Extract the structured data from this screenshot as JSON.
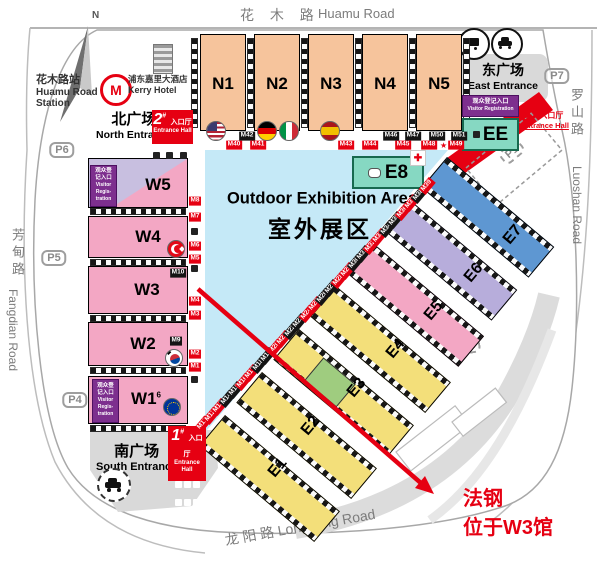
{
  "colors": {
    "accent_red": "#E60012",
    "hall_orange": "#F6C49C",
    "hall_pink": "#F3A7C4",
    "hall_yellow": "#F3DF7A",
    "hall_green": "#9FCC7F",
    "hall_lavender": "#B7ADDB",
    "hall_blue": "#5E97D2",
    "teal": "#86D8C2",
    "outdoor_blue": "#C5E9F7",
    "purple": "#7D2F8E"
  },
  "roads": {
    "north_zh": "花  木  路",
    "north_en": "Huamu Road",
    "east_zh": "罗山路",
    "east_en": "Luoshan Road",
    "west_zh": "芳甸路",
    "west_en": "Fangdian Road",
    "south_text": "龙  阳  路  Longyang Road"
  },
  "compass_label": "N",
  "station": {
    "zh": "花木路站",
    "en1": "Huamu Road",
    "en2": "Station",
    "logo_letter": "M"
  },
  "hotel": {
    "zh": "浦东嘉里大酒店",
    "en": "Kerry Hotel"
  },
  "plazas": {
    "north_zh": "北广场",
    "north_en": "North Entrance",
    "south_zh": "南广场",
    "south_en": "South Entrance",
    "east_zh": "东广场",
    "east_en": "East Entrance"
  },
  "entrance_halls": {
    "no1": {
      "num": "1",
      "hash": "#",
      "zh": "入口厅",
      "en": "Entrance Hall"
    },
    "no2": {
      "num": "2",
      "hash": "#",
      "zh": "入口厅",
      "en": "Entrance Hall"
    },
    "no3": {
      "num": "3",
      "hash": "#",
      "zh": "入口厅",
      "en": "Entrance Hall"
    }
  },
  "visitor_reg": {
    "zh": "观众登记入口",
    "en": "Visitor Registration",
    "l1": "观众登",
    "l2": "记入口",
    "l3": "Visitor",
    "l4": "Regis-",
    "l5": "tration"
  },
  "outdoor": {
    "en": "Outdoor Exhibition Area",
    "zh": "室外展区"
  },
  "halls": {
    "n1": "N1",
    "n2": "N2",
    "n3": "N3",
    "n4": "N4",
    "n5": "N5",
    "w1": "W1",
    "w1_sup": "6",
    "w2": "W2",
    "w3": "W3",
    "w4": "W4",
    "w5": "W5",
    "e8": "E8",
    "ee": "EE"
  },
  "e_labels": [
    {
      "label": "E1",
      "x": 278,
      "y": 468,
      "rot": -50
    },
    {
      "label": "E2",
      "x": 311,
      "y": 426,
      "rot": -50
    },
    {
      "label": "E3",
      "x": 357,
      "y": 388,
      "rot": -50
    },
    {
      "label": "E4",
      "x": 396,
      "y": 349,
      "rot": -50
    },
    {
      "label": "E5",
      "x": 434,
      "y": 311,
      "rot": -50
    },
    {
      "label": "E6",
      "x": 474,
      "y": 273,
      "rot": -50
    },
    {
      "label": "E7",
      "x": 513,
      "y": 235,
      "rot": -50
    }
  ],
  "parking": [
    {
      "label": "P1",
      "x": 512,
      "y": 152,
      "rot": -40,
      "cls": "p-dash"
    },
    {
      "label": "P2",
      "x": 468,
      "y": 346,
      "rot": -10,
      "cls": "p-dash"
    },
    {
      "label": "P3",
      "x": 382,
      "y": 432,
      "rot": -15,
      "cls": "p-dash"
    },
    {
      "label": "P4",
      "x": 75,
      "y": 400,
      "rot": 0
    },
    {
      "label": "P5",
      "x": 54,
      "y": 258,
      "rot": 0
    },
    {
      "label": "P6",
      "x": 62,
      "y": 150,
      "rot": 0
    },
    {
      "label": "P7",
      "x": 557,
      "y": 76,
      "rot": 0
    }
  ],
  "gates": {
    "north_black": [
      {
        "label": "M42",
        "x": 247,
        "y": 136,
        "cls": "g-black"
      },
      {
        "label": "M46",
        "x": 391,
        "y": 136,
        "cls": "g-black"
      },
      {
        "label": "M47",
        "x": 413,
        "y": 136,
        "cls": "g-black"
      },
      {
        "label": "M50",
        "x": 437,
        "y": 136,
        "cls": "g-black"
      },
      {
        "label": "M51",
        "x": 459,
        "y": 136,
        "cls": "g-black"
      }
    ],
    "north_red": [
      {
        "label": "M40",
        "x": 234,
        "y": 145,
        "cls": "g-red"
      },
      {
        "label": "M41",
        "x": 258,
        "y": 145,
        "cls": "g-red"
      },
      {
        "label": "M43",
        "x": 346,
        "y": 145,
        "cls": "g-red"
      },
      {
        "label": "M44",
        "x": 370,
        "y": 145,
        "cls": "g-red"
      },
      {
        "label": "M45",
        "x": 403,
        "y": 145,
        "cls": "g-red"
      },
      {
        "label": "M48",
        "x": 429,
        "y": 145,
        "cls": "g-red"
      },
      {
        "label": "M49",
        "x": 456,
        "y": 145,
        "cls": "g-red"
      }
    ],
    "west": [
      {
        "label": "M8",
        "x": 195,
        "y": 201,
        "cls": "g-red"
      },
      {
        "label": "M7",
        "x": 195,
        "y": 217,
        "cls": "g-red"
      },
      {
        "label": "M6",
        "x": 195,
        "y": 246,
        "cls": "g-red"
      },
      {
        "label": "M5",
        "x": 195,
        "y": 259,
        "cls": "g-red"
      },
      {
        "label": "M10",
        "x": 178,
        "y": 273,
        "cls": "g-black"
      },
      {
        "label": "M4",
        "x": 195,
        "y": 301,
        "cls": "g-red"
      },
      {
        "label": "M3",
        "x": 195,
        "y": 315,
        "cls": "g-red"
      },
      {
        "label": "M9",
        "x": 176,
        "y": 341,
        "cls": "g-black"
      },
      {
        "label": "M2",
        "x": 195,
        "y": 354,
        "cls": "g-red"
      },
      {
        "label": "M1",
        "x": 195,
        "y": 367,
        "cls": "g-red"
      }
    ],
    "diag": [
      {
        "label": "M11",
        "x": 203,
        "y": 424,
        "rot": -50,
        "cls": "g-red"
      },
      {
        "label": "M12",
        "x": 211,
        "y": 416,
        "rot": -50,
        "cls": "g-red"
      },
      {
        "label": "M13",
        "x": 219,
        "y": 407,
        "rot": -50,
        "cls": "g-red"
      },
      {
        "label": "M14",
        "x": 227,
        "y": 399,
        "rot": -50,
        "cls": "g-black"
      },
      {
        "label": "M15",
        "x": 235,
        "y": 390,
        "rot": -50,
        "cls": "g-black"
      },
      {
        "label": "M16",
        "x": 243,
        "y": 382,
        "rot": -50,
        "cls": "g-red"
      },
      {
        "label": "M17",
        "x": 251,
        "y": 373,
        "rot": -50,
        "cls": "g-red"
      },
      {
        "label": "M18",
        "x": 259,
        "y": 365,
        "rot": -50,
        "cls": "g-black"
      },
      {
        "label": "M19",
        "x": 267,
        "y": 356,
        "rot": -50,
        "cls": "g-black"
      },
      {
        "label": "M20",
        "x": 275,
        "y": 348,
        "rot": -50,
        "cls": "g-red"
      },
      {
        "label": "M21",
        "x": 283,
        "y": 339,
        "rot": -50,
        "cls": "g-red"
      },
      {
        "label": "M22",
        "x": 291,
        "y": 331,
        "rot": -50,
        "cls": "g-black"
      },
      {
        "label": "M23",
        "x": 299,
        "y": 322,
        "rot": -50,
        "cls": "g-black"
      },
      {
        "label": "M24",
        "x": 307,
        "y": 314,
        "rot": -50,
        "cls": "g-red"
      },
      {
        "label": "M25",
        "x": 315,
        "y": 305,
        "rot": -50,
        "cls": "g-red"
      },
      {
        "label": "M26",
        "x": 323,
        "y": 297,
        "rot": -50,
        "cls": "g-black"
      },
      {
        "label": "M27",
        "x": 331,
        "y": 288,
        "rot": -50,
        "cls": "g-black"
      },
      {
        "label": "M28",
        "x": 339,
        "y": 280,
        "rot": -50,
        "cls": "g-red"
      },
      {
        "label": "M29",
        "x": 347,
        "y": 271,
        "rot": -50,
        "cls": "g-red"
      },
      {
        "label": "M30",
        "x": 355,
        "y": 263,
        "rot": -50,
        "cls": "g-black"
      },
      {
        "label": "M31",
        "x": 363,
        "y": 254,
        "rot": -50,
        "cls": "g-black"
      },
      {
        "label": "M32",
        "x": 371,
        "y": 246,
        "rot": -50,
        "cls": "g-red"
      },
      {
        "label": "M33",
        "x": 379,
        "y": 237,
        "rot": -50,
        "cls": "g-red"
      },
      {
        "label": "M34",
        "x": 387,
        "y": 229,
        "rot": -50,
        "cls": "g-black"
      },
      {
        "label": "M35",
        "x": 395,
        "y": 220,
        "rot": -50,
        "cls": "g-black"
      },
      {
        "label": "M36",
        "x": 403,
        "y": 212,
        "rot": -50,
        "cls": "g-red"
      },
      {
        "label": "M37",
        "x": 411,
        "y": 203,
        "rot": -50,
        "cls": "g-red"
      },
      {
        "label": "M38",
        "x": 419,
        "y": 195,
        "rot": -50,
        "cls": "g-black"
      },
      {
        "label": "M39",
        "x": 427,
        "y": 186,
        "rot": -50,
        "cls": "g-red"
      }
    ]
  },
  "annotation": {
    "line1": "法钢",
    "line2": "位于W3馆"
  },
  "star": "★",
  "cross": "✚",
  "icons": {
    "compass": "compass-north-icon",
    "metro": "metro-logo-icon",
    "hotel": "hotel-building-icon",
    "bus": "bus-icon",
    "car": "car-icon",
    "taxi": "taxi-icon",
    "flags": [
      "flag-usa-icon",
      "flag-germany-icon",
      "flag-italy-icon",
      "flag-spain-icon",
      "flag-turkey-icon",
      "flag-korea-icon",
      "flag-eu-icon"
    ],
    "medical": "red-cross-icon",
    "facility": "facility-icon"
  }
}
